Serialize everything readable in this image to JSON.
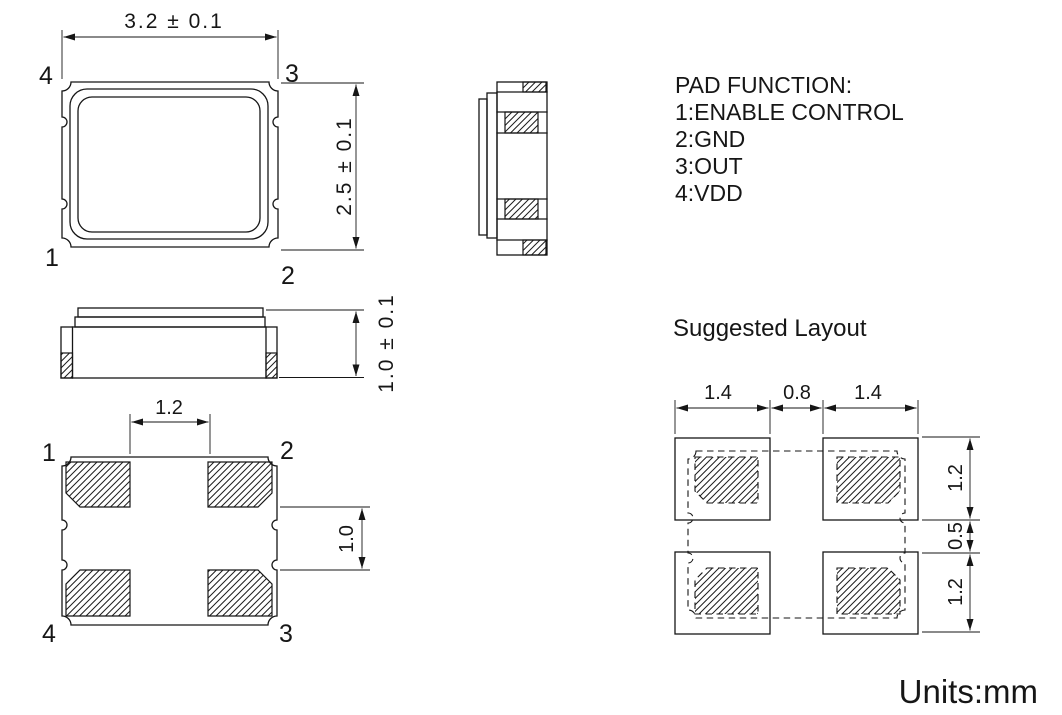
{
  "pad_function": {
    "title": "PAD FUNCTION:",
    "items": [
      "1:ENABLE CONTROL",
      "2:GND",
      "3:OUT",
      "4:VDD"
    ]
  },
  "top_view": {
    "dim_width": "3.2 ± 0.1",
    "dim_height": "2.5 ± 0.1",
    "pin_1": "1",
    "pin_2": "2",
    "pin_3": "3",
    "pin_4": "4"
  },
  "side_view": {
    "dim_height": "1.0 ± 0.1"
  },
  "bottom_view": {
    "dim_pad_gap_x": "1.2",
    "dim_pad_gap_y": "1.0",
    "pin_1": "1",
    "pin_2": "2",
    "pin_3": "3",
    "pin_4": "4"
  },
  "suggested_layout": {
    "title": "Suggested Layout",
    "dims_top": [
      "1.4",
      "0.8",
      "1.4"
    ],
    "dims_right": [
      "1.2",
      "0.5",
      "1.2"
    ]
  },
  "units_label": "Units:mm"
}
